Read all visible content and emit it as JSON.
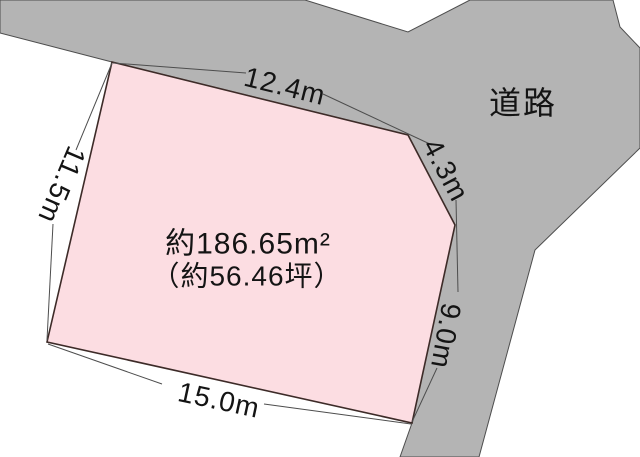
{
  "diagram": {
    "type": "land-plot-survey",
    "road_label": "道路",
    "area": {
      "square_meters_label": "約186.65m²",
      "tsubo_label": "（約56.46坪）"
    },
    "dimensions": {
      "top": "12.4m",
      "upper_right": "4.3m",
      "right": "9.0m",
      "bottom": "15.0m",
      "left": "11.5m"
    },
    "colors": {
      "plot_fill": "#fcdde2",
      "plot_stroke": "#3d2b28",
      "road_fill": "#b4b4b4",
      "road_stroke": "#4d4d4d",
      "background": "#ffffff",
      "text": "#141414"
    }
  }
}
